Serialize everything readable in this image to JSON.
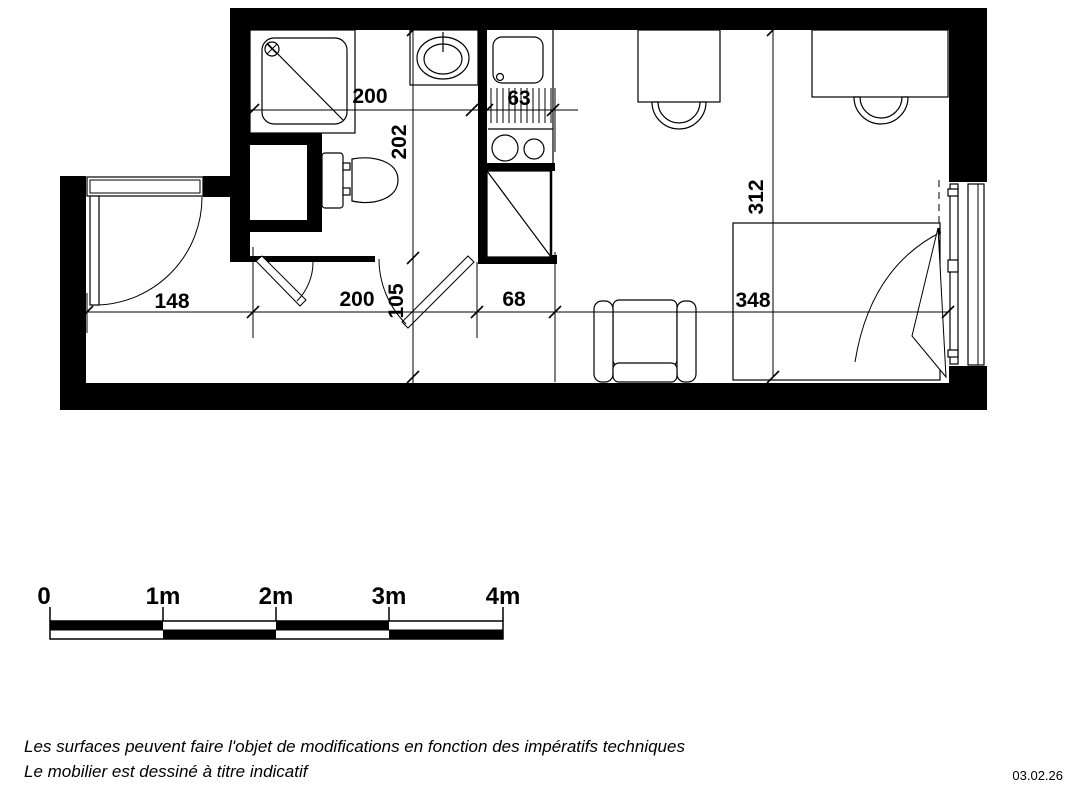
{
  "document": {
    "type": "apartment floor plan (studio)",
    "units": "cm"
  },
  "dimensions": {
    "bathroom_width": "200",
    "kitchen_width": "63",
    "bathroom_depth": "202",
    "room_depth": "312",
    "entry_width": "148",
    "hall_width": "200",
    "hall_depth": "105",
    "passage_width": "68",
    "room_width": "348"
  },
  "scale_bar": {
    "labels": [
      "0",
      "1m",
      "2m",
      "3m",
      "4m"
    ]
  },
  "footer": {
    "line1": "Les surfaces peuvent faire l'objet de modifications en fonction des impératifs techniques",
    "line2": "Le mobilier est dessiné à titre indicatif",
    "date": "03.02.26"
  },
  "colors": {
    "ink": "#000000",
    "paper": "#ffffff"
  }
}
